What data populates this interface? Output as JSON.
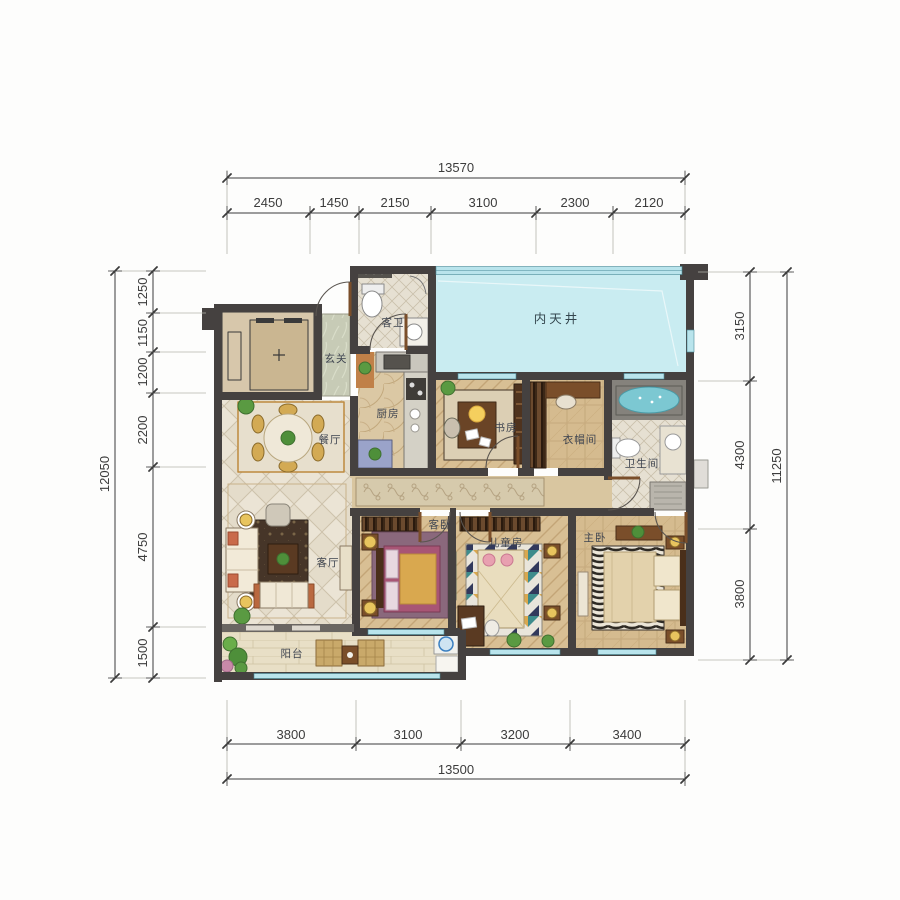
{
  "plan": {
    "rooms": [
      {
        "id": "courtyard",
        "label": "内天井"
      },
      {
        "id": "guest-bath",
        "label": "客卫"
      },
      {
        "id": "foyer",
        "label": "玄关"
      },
      {
        "id": "kitchen",
        "label": "厨房"
      },
      {
        "id": "dining",
        "label": "餐厅"
      },
      {
        "id": "study",
        "label": "书房"
      },
      {
        "id": "cloakroom",
        "label": "衣帽间"
      },
      {
        "id": "master-bath",
        "label": "卫生间"
      },
      {
        "id": "living",
        "label": "客厅"
      },
      {
        "id": "guest-bedroom",
        "label": "客卧"
      },
      {
        "id": "kids-room",
        "label": "儿童房"
      },
      {
        "id": "master-bedroom",
        "label": "主卧"
      },
      {
        "id": "balcony",
        "label": "阳台"
      }
    ]
  },
  "dims": {
    "top": {
      "total": "13570",
      "segments": [
        "2450",
        "1450",
        "2150",
        "3100",
        "2300",
        "2120"
      ]
    },
    "bottom": {
      "total": "13500",
      "segments": [
        "3800",
        "3100",
        "3200",
        "3400"
      ]
    },
    "left": {
      "total": "12050",
      "segments": [
        "1250",
        "1150",
        "1200",
        "2200",
        "4750",
        "1500"
      ]
    },
    "right": {
      "total": "11250",
      "segments": [
        "3150",
        "4300",
        "3800"
      ]
    }
  },
  "colors": {
    "wall": "#454140",
    "courtyard": "#c9ecf1",
    "glass": "#b9e4ec",
    "woodFloor": "#d8bf94",
    "tileFloor": "#ebe4d5",
    "accentWood": "#7a4e2a",
    "gold": "#d9a84f",
    "tub": "#7cc8d2",
    "dimText": "#3c3c3c"
  }
}
